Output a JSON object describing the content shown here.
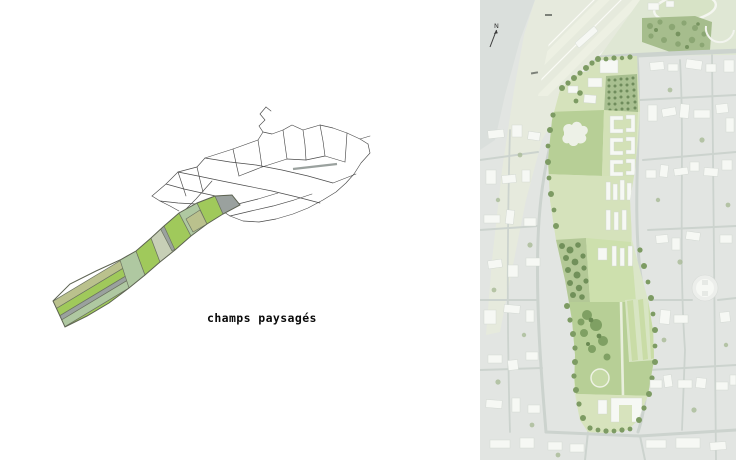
{
  "window": {
    "width": 736,
    "height": 460,
    "background": "#ffffff"
  },
  "left_panel": {
    "type": "concept-parcel-diagram",
    "caption": "champs paysagés",
    "palette": {
      "field_bright": "#a0c95b",
      "field_olive": "#bac18d",
      "field_sage": "#afc8a1",
      "field_pale": "#c7cfb6",
      "road_grey": "#9aa19e",
      "network_line": "#4a4a4a",
      "parcel_outline": "#6c7361"
    }
  },
  "right_panel": {
    "type": "masterplan-site-plan",
    "north_label": "N",
    "palette": {
      "urban_base": "#e2e5e2",
      "rough_land": "#dadfdc",
      "open_land": "#e6eadd",
      "runway_strip": "#eef1e5",
      "field_light": "#dfe7d4",
      "forest": "#a6bd8d",
      "park_base": "#dbe6c8",
      "park_lawn": "#b7cf96",
      "park_field": "#d5e2bb",
      "orchard_grid": "#a8bf90",
      "stripe_field": "#c9dca6",
      "tree_green": "#7d9b63",
      "tree_dark": "#6f8c5a",
      "building_white": "#f6f8f4",
      "road_grey": "#ccd3ce",
      "north_arrow": "#3c3c3c"
    }
  }
}
